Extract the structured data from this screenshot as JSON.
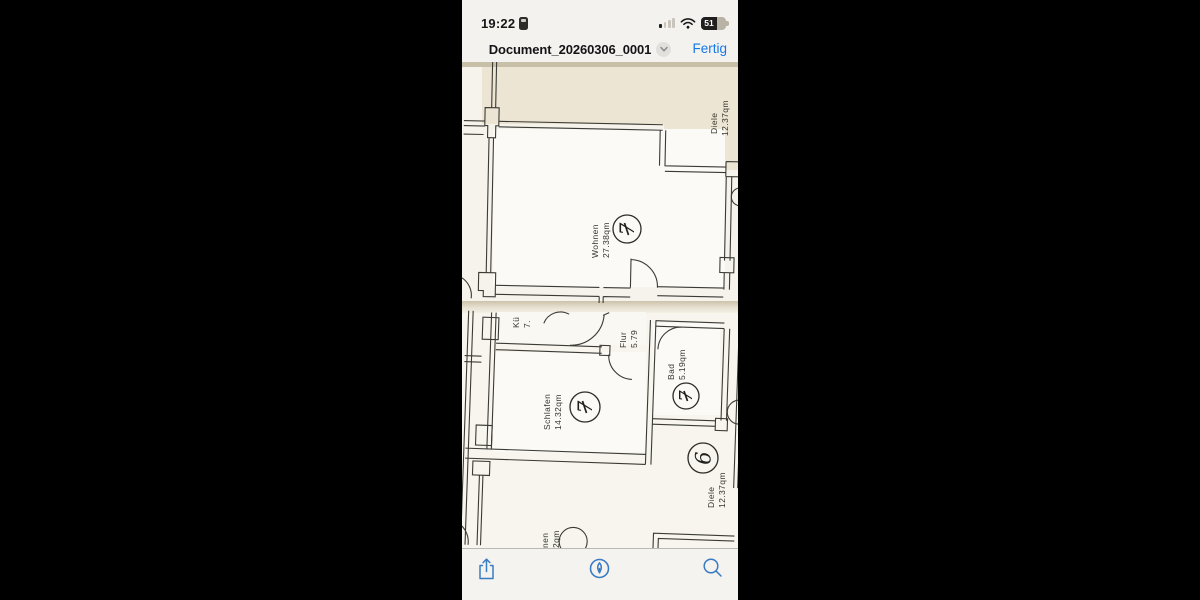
{
  "status_bar": {
    "time": "19:22",
    "battery_percent": "51"
  },
  "nav_bar": {
    "title": "Document_20260306_0001",
    "done_label": "Fertig"
  },
  "plan": {
    "description": "Scanned apartment floor plan, two overlapping scan pages",
    "rooms": [
      {
        "name": "Diele",
        "area": "12.37qm",
        "badge": ""
      },
      {
        "name": "Wohnen",
        "area": "27.38qm",
        "badge": "7"
      },
      {
        "name": "Kü",
        "area": "7.",
        "badge": ""
      },
      {
        "name": "Flur",
        "area": "5.79",
        "badge": ""
      },
      {
        "name": "Bad",
        "area": "5.19qm",
        "badge": "7"
      },
      {
        "name": "Schlafen",
        "area": "14.32qm",
        "badge": "7"
      },
      {
        "name": "Diele",
        "area": "12.37qm",
        "badge": "6"
      },
      {
        "name": "nen",
        "area": "2qm",
        "badge": ""
      }
    ]
  },
  "toolbar": {
    "icons": [
      "share-icon",
      "markup-icon",
      "search-icon"
    ]
  },
  "colors": {
    "accent_blue": "#1478e8",
    "toolbar_icon_blue": "#3a7cc2",
    "plan_ink": "#3b3a35"
  }
}
